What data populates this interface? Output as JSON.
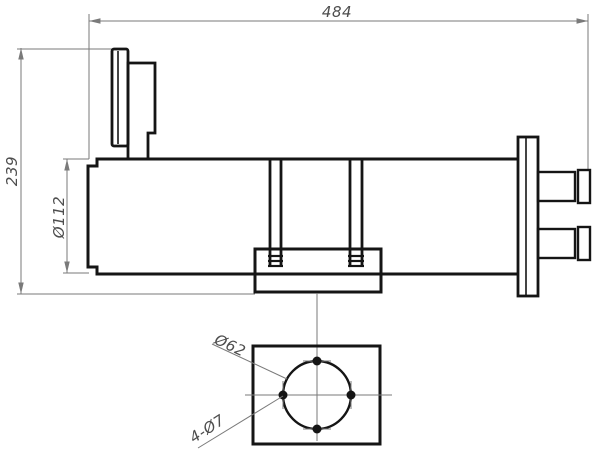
{
  "drawing": {
    "labels": {
      "length_overall": "484",
      "height_overall": "239",
      "body_diameter": "Ø112",
      "bolt_circle_diameter": "Ø62",
      "mounting_holes": "4-Ø7"
    },
    "colors": {
      "background": "#ffffff",
      "outline": "#151515",
      "thin_line": "#7a7a7a",
      "text": "#4d4d4d"
    }
  }
}
